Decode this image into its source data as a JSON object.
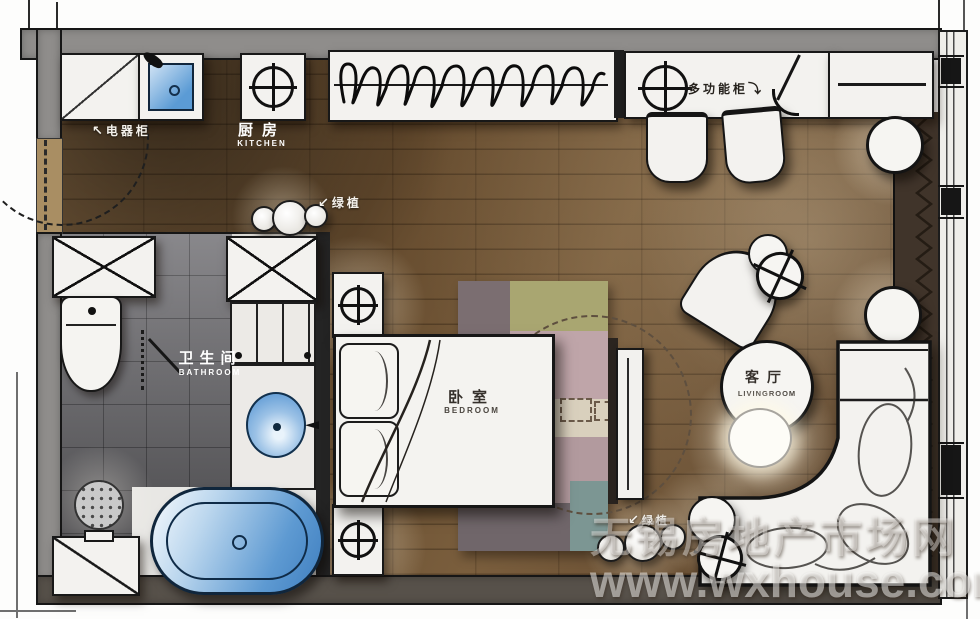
{
  "labels": {
    "kitchen": {
      "zh": "厨房",
      "en": "KITCHEN"
    },
    "bathroom": {
      "zh": "卫生间",
      "en": "BATHROOM"
    },
    "bedroom": {
      "zh": "卧室",
      "en": "BEDROOM"
    },
    "livingroom": {
      "zh": "客厅",
      "en": "LIVINGROOM"
    }
  },
  "annotations": {
    "appliance_cabinet": "电器柜",
    "multi_function_cabinet": "多功能柜",
    "plant_kitchen": "绿植",
    "plant_living": "绿植"
  },
  "icons": {
    "arrow_nw": "↖",
    "arrow_sw": "↙",
    "arrow_se": "⤵"
  },
  "watermark": {
    "site_name": "无锡房地产市场网",
    "url": "www.wxhouse.com"
  },
  "colors": {
    "accent_blue": "#5b9bd5",
    "wood_floor": "#6b5335",
    "tile_gray": "#78777b",
    "wall_gray": "#8f8d8b"
  }
}
